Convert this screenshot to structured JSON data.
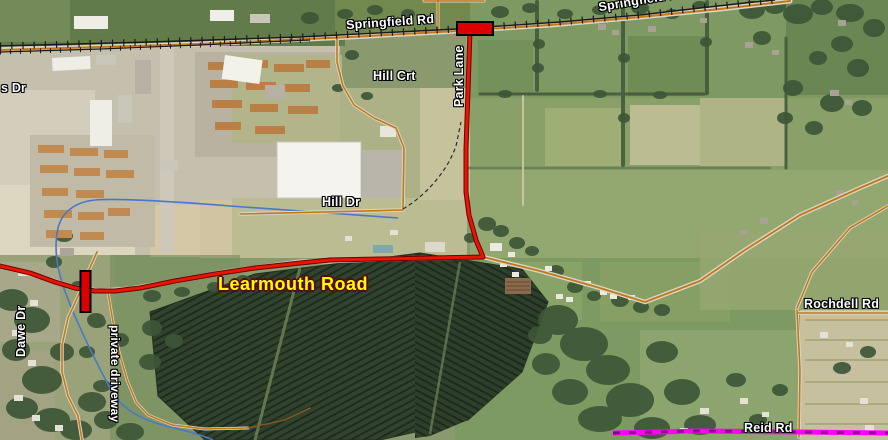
{
  "map": {
    "type": "aerial-road-map",
    "labels": {
      "partial_road_left": "s Dr",
      "springfield_rd_main": "Springfield Rd",
      "springfield_rd_upper": "Springfield Rd",
      "hill_crt": "Hill Crt",
      "park_lane": "Park Lane",
      "hill_dr": "Hill Dr",
      "learmouth_road": "Learmouth Road",
      "dawe_dr": "Dawe Dr",
      "private_driveway": "private driveway",
      "rochdell_rd": "Rochdell Rd",
      "reid_rd": "Reid Rd"
    },
    "colors": {
      "route_highlight": "#e81600",
      "closure_marker": "#dd0000",
      "road_overlay": "#c07818",
      "railroad": "#1a1a1a",
      "creek": "#4878c8",
      "boundary_magenta": "#ff00ff",
      "label_text": "#ffffff",
      "learmouth_label_text": "#ffff00"
    }
  }
}
